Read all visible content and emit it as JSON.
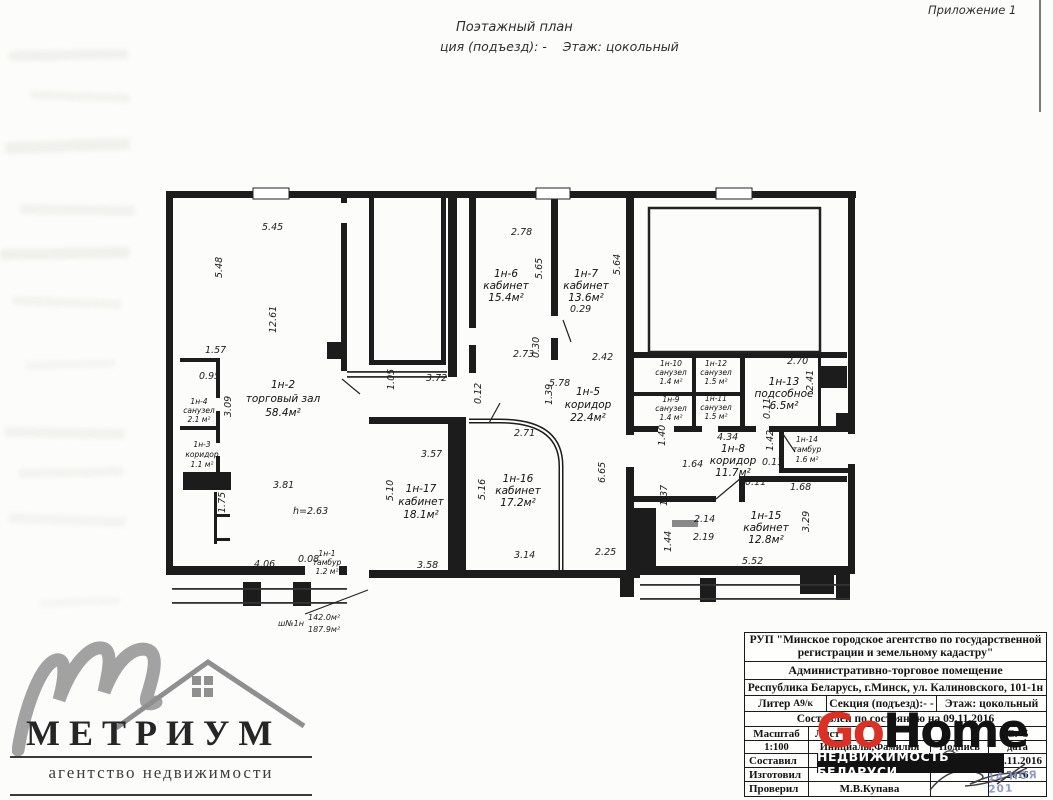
{
  "page": {
    "annex": "Приложение 1",
    "title_line1": "Поэтажный план",
    "title_line2": "ция (подъезд): -    Этаж: цокольный"
  },
  "plan": {
    "rooms": [
      {
        "id": "1н-2",
        "name": "торговый зал",
        "area": "58.4м²",
        "x": 283,
        "y": 388,
        "lh": 14
      },
      {
        "id": "1н-4",
        "name": "санузел",
        "area": "2.1 м²",
        "x": 199,
        "y": 404,
        "lh": 9,
        "s": 1
      },
      {
        "id": "1н-3",
        "name": "коридор",
        "area": "1.1 м²",
        "x": 202,
        "y": 447,
        "lh": 10,
        "s": 1
      },
      {
        "id": "1н-1",
        "name": "тамбур",
        "area": "1.2 м²",
        "x": 327,
        "y": 556,
        "lh": 9,
        "s": 1
      },
      {
        "id": "1н-6",
        "name": "кабинет",
        "area": "15.4м²",
        "x": 506,
        "y": 277,
        "lh": 12
      },
      {
        "id": "1н-7",
        "name": "кабинет",
        "area": "13.6м²",
        "x": 586,
        "y": 277,
        "lh": 12
      },
      {
        "id": "1н-5",
        "name": "коридор",
        "area": "22.4м²",
        "x": 588,
        "y": 395,
        "lh": 13
      },
      {
        "id": "1н-17",
        "name": "кабинет",
        "area": "18.1м²",
        "x": 421,
        "y": 492,
        "lh": 13
      },
      {
        "id": "1н-16",
        "name": "кабинет",
        "area": "17.2м²",
        "x": 518,
        "y": 482,
        "lh": 12
      },
      {
        "id": "1н-10",
        "name": "санузел",
        "area": "1.4 м²",
        "x": 671,
        "y": 366,
        "lh": 9,
        "s": 1
      },
      {
        "id": "1н-12",
        "name": "санузел",
        "area": "1.5 м²",
        "x": 716,
        "y": 366,
        "lh": 9,
        "s": 1
      },
      {
        "id": "1н-9",
        "name": "санузел",
        "area": "1.4 м²",
        "x": 671,
        "y": 402,
        "lh": 9,
        "s": 1
      },
      {
        "id": "1н-11",
        "name": "санузел",
        "area": "1.5 м²",
        "x": 716,
        "y": 401,
        "lh": 9,
        "s": 1
      },
      {
        "id": "1н-13",
        "name": "подсобное",
        "area": "6.5м²",
        "x": 784,
        "y": 385,
        "lh": 12
      },
      {
        "id": "1н-8",
        "name": "коридор",
        "area": "11.7м²",
        "x": 733,
        "y": 452,
        "lh": 12
      },
      {
        "id": "1н-14",
        "name": "тамбур",
        "area": "1.6 м²",
        "x": 807,
        "y": 442,
        "lh": 10,
        "s": 1
      },
      {
        "id": "1н-15",
        "name": "кабинет",
        "area": "12.8м²",
        "x": 766,
        "y": 519,
        "lh": 12
      }
    ],
    "dims": [
      {
        "t": "5.45",
        "x": 262,
        "y": 230
      },
      {
        "t": "5.48",
        "x": 222,
        "y": 278,
        "r": -90
      },
      {
        "t": "12.61",
        "x": 276,
        "y": 333,
        "r": -90
      },
      {
        "t": "1.57",
        "x": 205,
        "y": 353
      },
      {
        "t": "0.95",
        "x": 199,
        "y": 379
      },
      {
        "t": "3.09",
        "x": 231,
        "y": 417,
        "r": -90
      },
      {
        "t": "3.81",
        "x": 273,
        "y": 488
      },
      {
        "t": "h=2.63",
        "x": 293,
        "y": 514
      },
      {
        "t": "1.75",
        "x": 225,
        "y": 513,
        "r": -90
      },
      {
        "t": "4.06",
        "x": 254,
        "y": 567
      },
      {
        "t": "0.08",
        "x": 298,
        "y": 562
      },
      {
        "t": "1.05",
        "x": 394,
        "y": 390,
        "r": -90
      },
      {
        "t": "3.72",
        "x": 426,
        "y": 381
      },
      {
        "t": "3.57",
        "x": 421,
        "y": 457
      },
      {
        "t": "5.10",
        "x": 393,
        "y": 501,
        "r": -90
      },
      {
        "t": "3.58",
        "x": 417,
        "y": 568
      },
      {
        "t": "5.16",
        "x": 485,
        "y": 500,
        "r": -90
      },
      {
        "t": "3.14",
        "x": 514,
        "y": 558
      },
      {
        "t": "2.25",
        "x": 595,
        "y": 555
      },
      {
        "t": "2.71",
        "x": 514,
        "y": 436
      },
      {
        "t": "0.12",
        "x": 481,
        "y": 404,
        "r": -90
      },
      {
        "t": "2.78",
        "x": 511,
        "y": 235
      },
      {
        "t": "5.65",
        "x": 542,
        "y": 279,
        "r": -90
      },
      {
        "t": "5.64",
        "x": 620,
        "y": 275,
        "r": -90
      },
      {
        "t": "0.29",
        "x": 570,
        "y": 312
      },
      {
        "t": "2.73",
        "x": 513,
        "y": 357
      },
      {
        "t": "0.30",
        "x": 539,
        "y": 358,
        "r": -90
      },
      {
        "t": "2.42",
        "x": 592,
        "y": 360
      },
      {
        "t": "5.78",
        "x": 549,
        "y": 386
      },
      {
        "t": "1.39",
        "x": 552,
        "y": 405,
        "r": -90
      },
      {
        "t": "6.65",
        "x": 605,
        "y": 483,
        "r": -90
      },
      {
        "t": "2.70",
        "x": 787,
        "y": 364
      },
      {
        "t": "2.41",
        "x": 813,
        "y": 391,
        "r": -90
      },
      {
        "t": "0.11",
        "x": 770,
        "y": 419,
        "r": -90
      },
      {
        "t": "4.34",
        "x": 717,
        "y": 440
      },
      {
        "t": "1.40",
        "x": 665,
        "y": 446,
        "r": -90
      },
      {
        "t": "1.64",
        "x": 682,
        "y": 467
      },
      {
        "t": "1.42",
        "x": 773,
        "y": 451,
        "r": -90
      },
      {
        "t": "0.11",
        "x": 762,
        "y": 465
      },
      {
        "t": "0.11",
        "x": 745,
        "y": 485
      },
      {
        "t": "1.68",
        "x": 790,
        "y": 490
      },
      {
        "t": "1.37",
        "x": 667,
        "y": 506,
        "r": -90
      },
      {
        "t": "2.14",
        "x": 694,
        "y": 522
      },
      {
        "t": "2.19",
        "x": 693,
        "y": 540
      },
      {
        "t": "1.44",
        "x": 671,
        "y": 552,
        "r": -90
      },
      {
        "t": "3.29",
        "x": 809,
        "y": 532,
        "r": -90
      },
      {
        "t": "5.52",
        "x": 742,
        "y": 564
      }
    ],
    "note": {
      "label": "ш№1н",
      "area1": "142.0м²",
      "area2": "187.9м²"
    }
  },
  "titleblock": {
    "org_line1": "РУП \"Минское городское агентство по государственной",
    "org_line2": "регистрации и земельному кадастру\"",
    "object": "Административно-торговое помещение",
    "address": "Республика Беларусь, г.Минск, ул. Калиновского, 101-1н",
    "liter_label": "Литер",
    "liter_value": "А9/к",
    "section": "Секция (подъезд):- -",
    "floor": "Этаж: цокольный",
    "compiled": "Составлен по состоянию на 09.11.2016",
    "scale_label": "Масштаб",
    "sheet_label": "Лист",
    "pages": "С.",
    "pages_num": "5",
    "scale_value": "1:100",
    "name_header": "Инициалы,Фамилия",
    "sign_header": "Подпись",
    "date_header": "дата",
    "rows": [
      {
        "role": "Составил",
        "name": "Н.А.Лукашева",
        "date": "14.11.2016"
      },
      {
        "role": "Изготовил",
        "name": "",
        "date": "2016"
      },
      {
        "role": "Проверил",
        "name": "М.В.Купава",
        "date": ""
      }
    ],
    "stamp": "14 НОЯ 201"
  },
  "watermark": {
    "go": "Go",
    "home": "Home",
    "bar": "НЕДВИЖИМОСТЬ БЕЛАРУСИ",
    "red": "#d93125"
  },
  "metrium": {
    "name": "МЕТРИУМ",
    "tagline": "агентство недвижимости"
  }
}
